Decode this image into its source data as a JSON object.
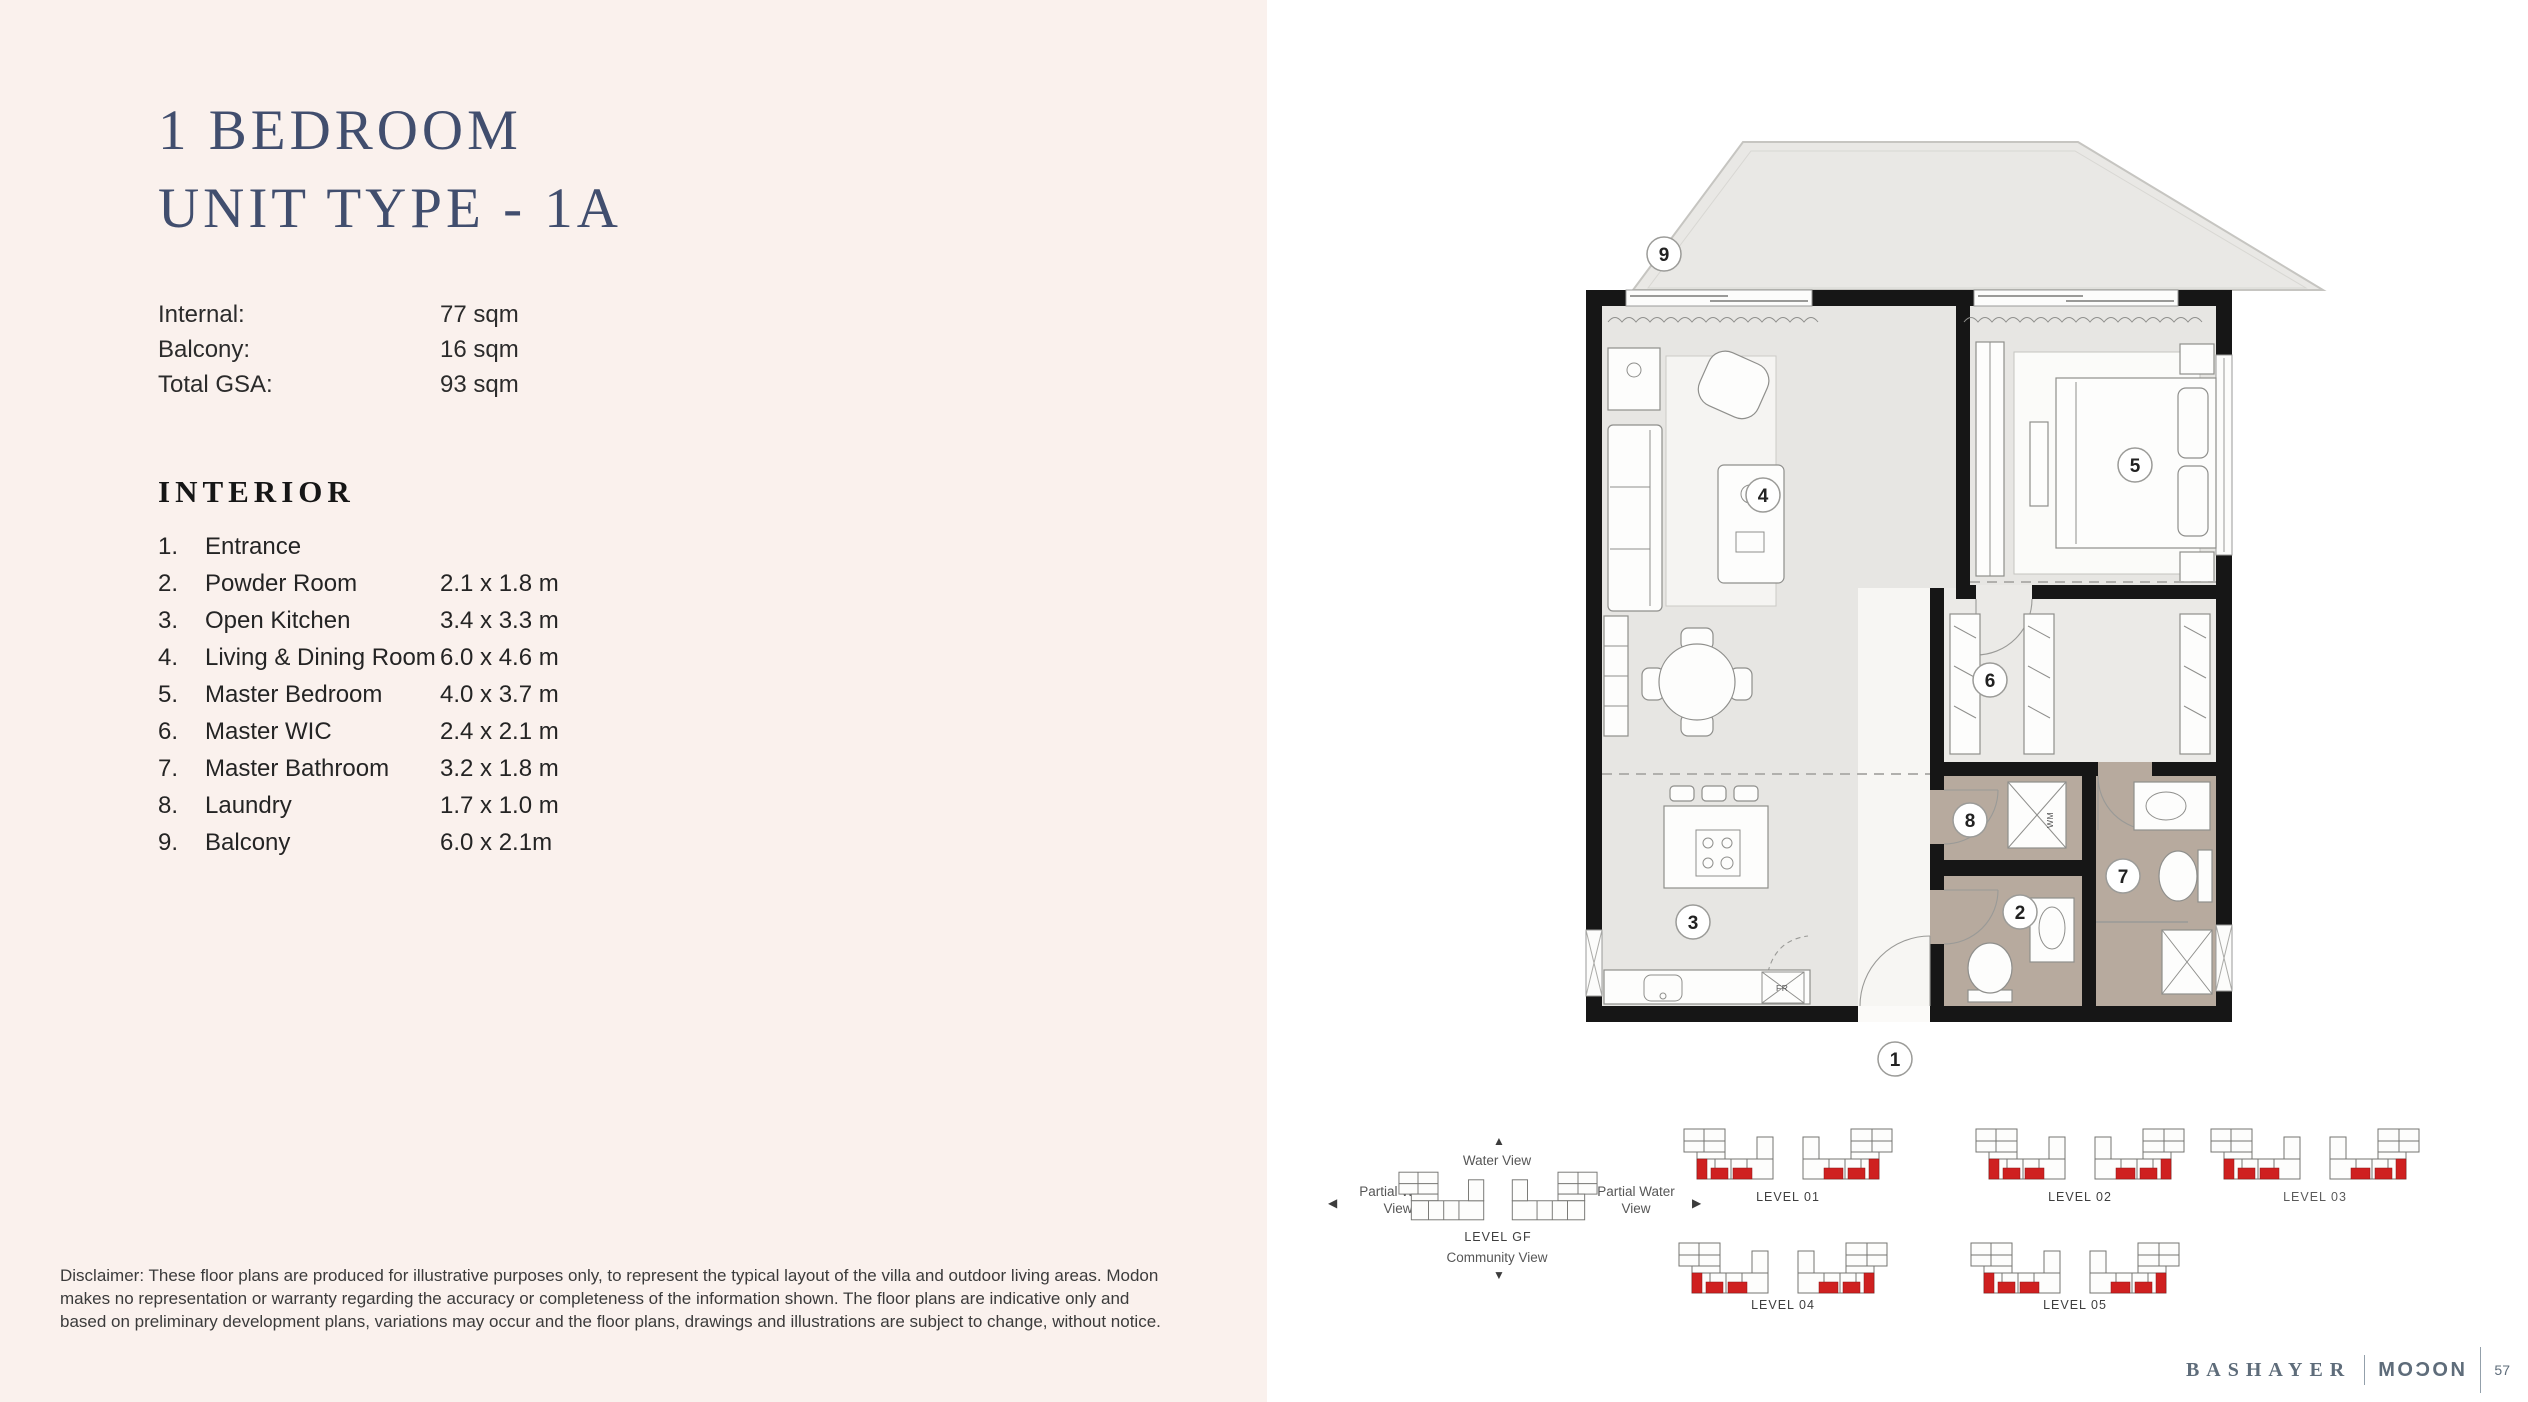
{
  "unit": {
    "title_line1": "1 BEDROOM",
    "title_line2": "UNIT TYPE - 1A",
    "stats": [
      {
        "label": "Internal:",
        "value": "77 sqm"
      },
      {
        "label": "Balcony:",
        "value": "16 sqm"
      },
      {
        "label": "Total GSA:",
        "value": "93 sqm"
      }
    ],
    "interior_heading": "INTERIOR",
    "interior_items": [
      {
        "num": "1.",
        "name": "Entrance",
        "dims": ""
      },
      {
        "num": "2.",
        "name": "Powder Room",
        "dims": "2.1 x 1.8 m"
      },
      {
        "num": "3.",
        "name": "Open Kitchen",
        "dims": "3.4 x 3.3 m"
      },
      {
        "num": "4.",
        "name": "Living & Dining Room",
        "dims": "6.0 x 4.6 m"
      },
      {
        "num": "5.",
        "name": "Master Bedroom",
        "dims": "4.0 x 3.7 m"
      },
      {
        "num": "6.",
        "name": "Master WIC",
        "dims": "2.4 x 2.1 m"
      },
      {
        "num": "7.",
        "name": "Master Bathroom",
        "dims": "3.2 x 1.8 m"
      },
      {
        "num": "8.",
        "name": "Laundry",
        "dims": "1.7 x 1.0 m"
      },
      {
        "num": "9.",
        "name": "Balcony",
        "dims": "6.0 x 2.1m"
      }
    ],
    "disclaimer": "Disclaimer: These floor plans are produced for illustrative purposes only, to represent the typical layout of the villa and outdoor living areas. Modon makes no representation or warranty regarding the accuracy or completeness of the information shown. The floor plans are indicative only and based on preliminary development plans, variations may occur and the floor plans, drawings and illustrations are subject to change, without notice."
  },
  "floor_plan": {
    "numbers": [
      "1",
      "2",
      "3",
      "4",
      "5",
      "6",
      "7",
      "8",
      "9"
    ],
    "annotations": {
      "washing_machine": "WM",
      "fridge": "FR"
    }
  },
  "key_plan": {
    "water_view": "Water View",
    "partial_water_view_left": "Partial Water View",
    "partial_water_view_right": "Partial Water View",
    "community_view": "Community View",
    "level_gf": "LEVEL GF",
    "levels": [
      "LEVEL 01",
      "LEVEL 02",
      "LEVEL 03",
      "LEVEL 04",
      "LEVEL 05"
    ]
  },
  "footer": {
    "brand_left": "BASHAYER",
    "brand_right": "MOƆON",
    "page_number": "57"
  },
  "colors": {
    "panel_pink": "#faf1ed",
    "navy": "#414e6e",
    "taupe": "#b7aa9e",
    "floor_gray": "#e7e6e3",
    "red_unit": "#cf2020",
    "footer_gray": "#5e6c7a"
  }
}
